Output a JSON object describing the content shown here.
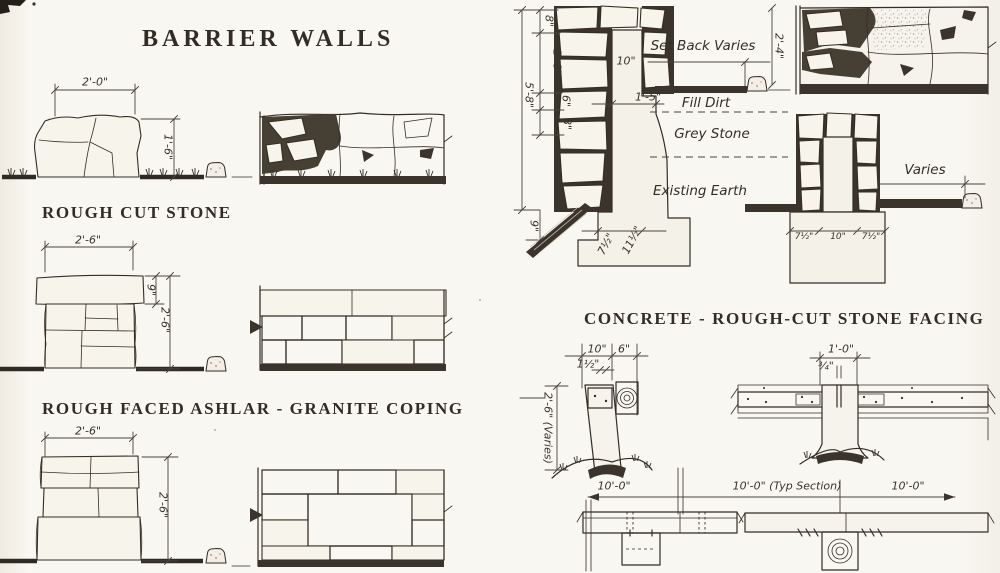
{
  "page": {
    "title": "BARRIER WALLS",
    "ink": "#332d25",
    "paper": "#f9f7f1"
  },
  "left": {
    "s1": {
      "caption": "ROUGH CUT STONE",
      "w": "2'-0\"",
      "h": "1'-6\""
    },
    "s2": {
      "caption": "ROUGH FACED ASHLAR - GRANITE COPING",
      "w": "2'-6\"",
      "coping": "9\"",
      "h": "2'-6\""
    },
    "s3": {
      "w": "2'-6\"",
      "h": "2'-6\""
    }
  },
  "right": {
    "caption": "CONCRETE - ROUGH-CUT STONE FACING",
    "wall": {
      "d8a": "8\"",
      "d18": "1'-8\"",
      "d58": "5'-8\"",
      "d6": "6\"",
      "d8b": "8\"",
      "d10": "10\"",
      "d15": "1'-5\"",
      "d9": "9\"",
      "d24": "2'-4\"",
      "foot_a": "7½\"",
      "foot_b": "11½\"",
      "set_back": "Set Back Varies",
      "fill_dirt": "Fill Dirt",
      "grey_stone": "Grey Stone",
      "existing_earth": "Existing Earth"
    },
    "wall2": {
      "varies": "Varies",
      "f1": "7½\"",
      "f2": "10\"",
      "f3": "7½\""
    }
  },
  "timber": {
    "left": {
      "d10": "10\"",
      "d6": "6\"",
      "d15": "1½\"",
      "d26": "2'-6\" (Varies)",
      "d100": "10'-0\""
    },
    "right": {
      "d10": "1'-0\"",
      "d34": "¾\"",
      "typ": "10'-0\" (Typ Section)",
      "d100": "10'-0\""
    }
  }
}
